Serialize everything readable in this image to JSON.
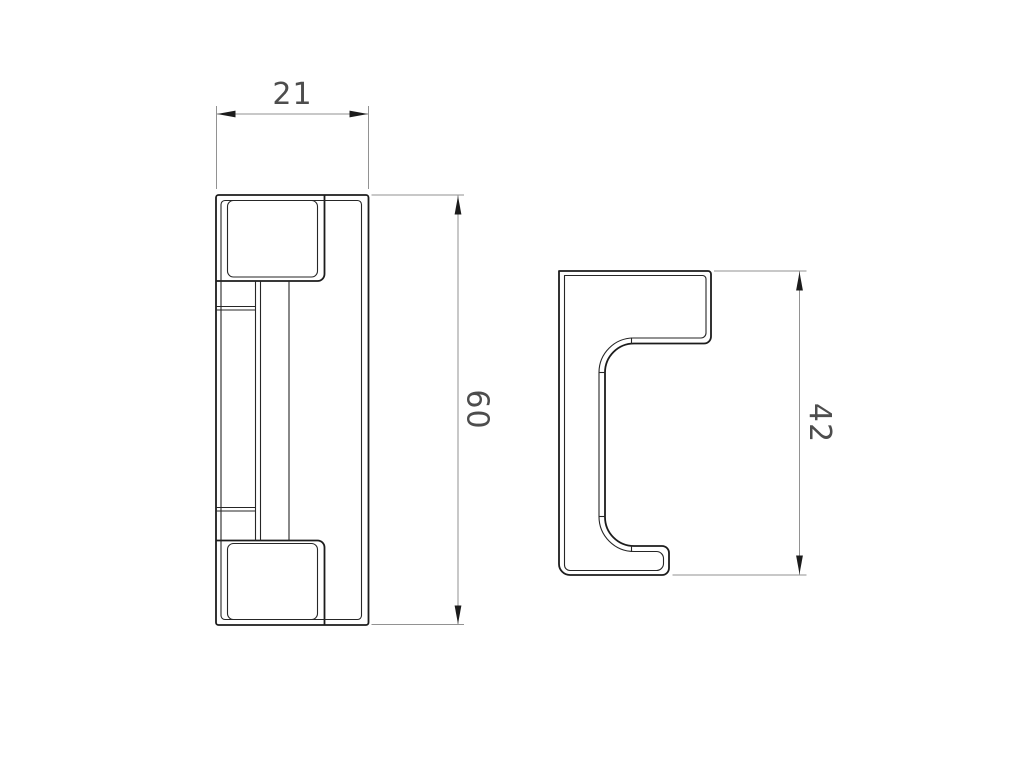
{
  "sheet": {
    "background": "#ffffff",
    "description": "2-view CAD engineering drawing of a hook bracket part"
  },
  "drawing": {
    "colors": {
      "object_line": "#1c1c1c",
      "fillet_line": "#262626",
      "dimension_line": "#929292",
      "arrow": "#1c1c1c",
      "dimension_text": "#4d4d4d"
    },
    "views": {
      "front": {
        "dimensions": {
          "width": {
            "value": "21"
          },
          "height": {
            "value": "60"
          }
        }
      },
      "side": {
        "dimensions": {
          "height": {
            "value": "42"
          }
        }
      }
    }
  }
}
